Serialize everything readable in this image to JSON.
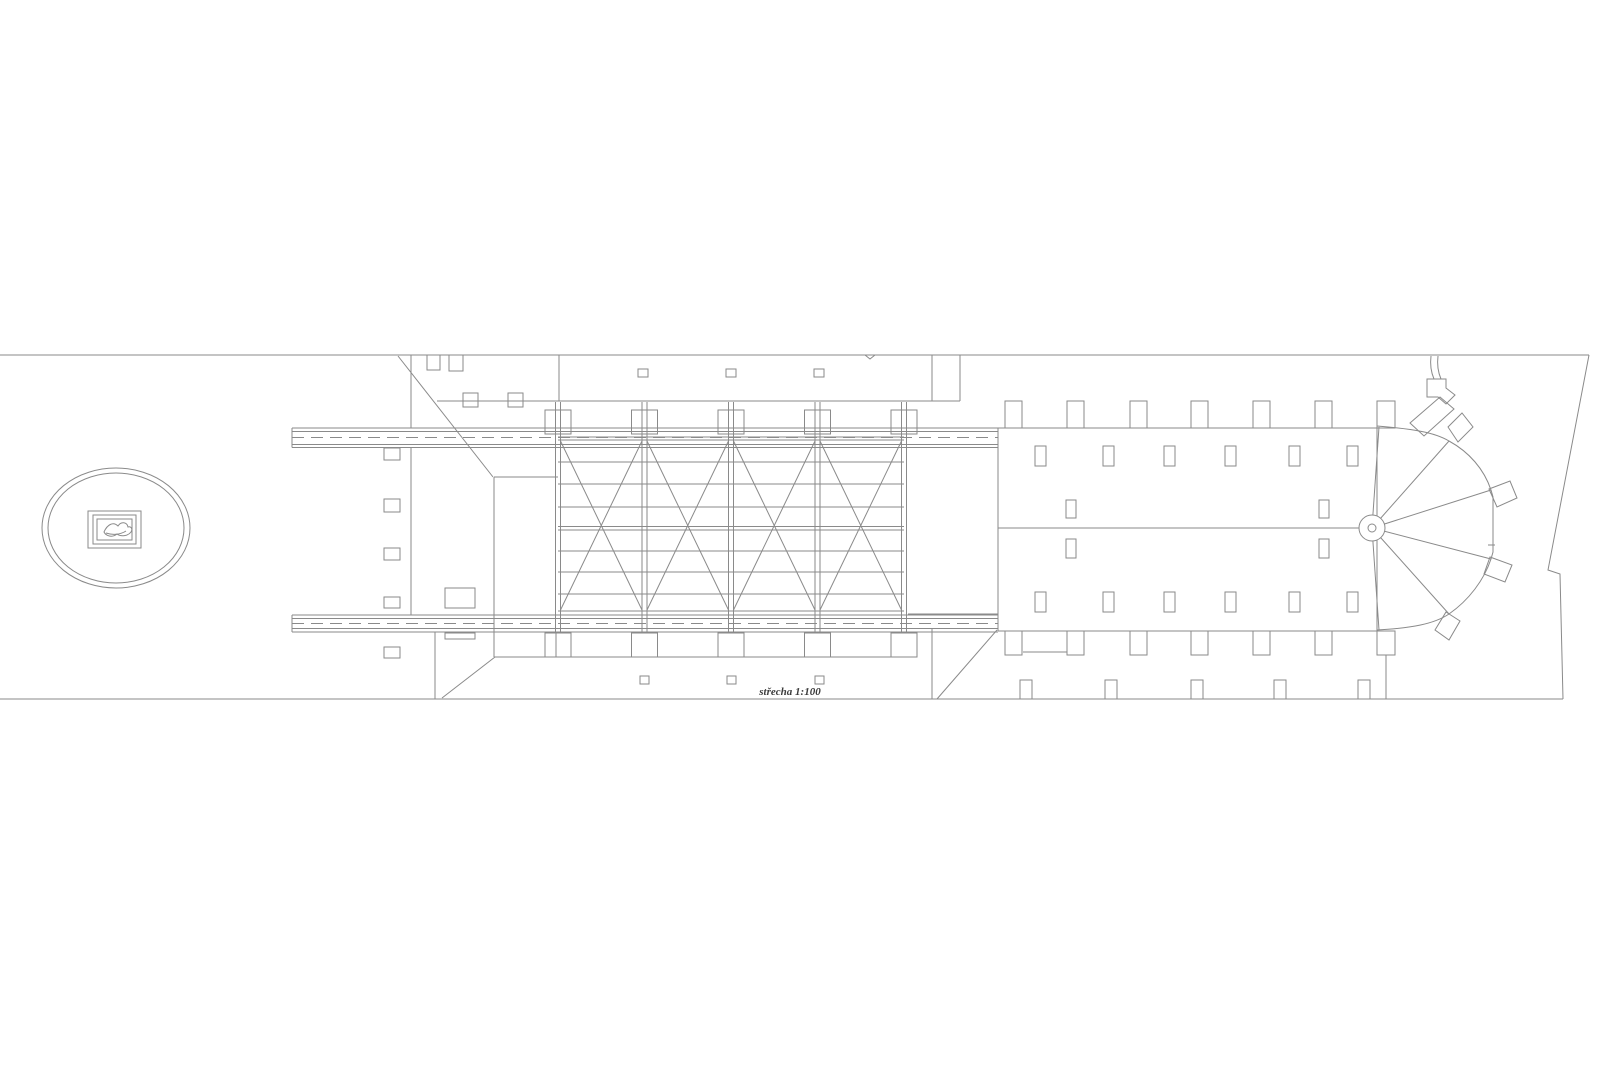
{
  "page": {
    "background": "#ffffff",
    "label": "střecha 1:100"
  },
  "drawing": {
    "stroke": "#8a8a8a",
    "stroke_width": 1,
    "dash": "12 7",
    "label_x": 790,
    "label_y": 695,
    "groups": [
      {
        "name": "site-boundary",
        "lines": [
          [
            0,
            355,
            1589,
            355
          ],
          [
            0,
            699,
            1563,
            699
          ]
        ],
        "polylines": [
          "1589,355 1548,570 1560,574 1563,699",
          "865,355 870,359 875,355"
        ]
      },
      {
        "name": "garden-ellipse-emblem",
        "ellipses": [
          [
            116,
            528,
            74,
            60
          ],
          [
            116,
            528,
            68,
            55
          ]
        ],
        "rects": [
          [
            88,
            511,
            53,
            37
          ],
          [
            93,
            515,
            43,
            29
          ],
          [
            97,
            519,
            35,
            21
          ]
        ],
        "paths": [
          "M104,532 C107,525 113,521 118,526 C121,521 127,522 128,527 C131,526 133,529 131,532 C128,536 121,537 117,534 C112,538 106,536 104,532 Z",
          "M106,533 C112,535 120,535 126,531"
        ]
      },
      {
        "name": "gallery-beams",
        "lines": [
          [
            292,
            428,
            1378,
            428
          ],
          [
            292,
            431.5,
            998,
            431.5
          ],
          [
            292,
            444.5,
            998,
            444.5
          ],
          [
            292,
            447.5,
            998,
            447.5
          ],
          [
            292,
            615,
            998,
            615
          ],
          [
            292,
            618.5,
            998,
            618.5
          ],
          [
            292,
            628.5,
            998,
            628.5
          ],
          [
            292,
            632,
            998,
            632
          ],
          [
            998,
            631,
            1378,
            631
          ],
          [
            292,
            428,
            292,
            447.5
          ],
          [
            292,
            615,
            292,
            632
          ]
        ],
        "dashed": [
          [
            292,
            437.5,
            998,
            437.5
          ],
          [
            292,
            623.5,
            998,
            623.5
          ]
        ]
      },
      {
        "name": "courtyard-walls",
        "lines": [
          [
            908,
            447.5,
            998,
            447.5
          ],
          [
            908,
            614,
            998,
            614
          ]
        ]
      },
      {
        "name": "north-wing",
        "lines": [
          [
            559,
            355,
            559,
            401
          ],
          [
            932,
            355,
            932,
            401
          ],
          [
            437,
            401,
            960,
            401
          ],
          [
            960,
            355,
            960,
            401
          ],
          [
            411,
            355,
            411,
            428
          ],
          [
            411,
            447,
            411,
            615
          ]
        ],
        "rects": [
          [
            638,
            369,
            10,
            8
          ],
          [
            726,
            369,
            10,
            8
          ],
          [
            814,
            369,
            10,
            8
          ],
          [
            427,
            355,
            13,
            15
          ],
          [
            449,
            355,
            14,
            16
          ],
          [
            463,
            393,
            15,
            14
          ],
          [
            508,
            393,
            15,
            14
          ]
        ]
      },
      {
        "name": "west-roof",
        "lines": [
          [
            398,
            356,
            493,
            477
          ],
          [
            494,
            477,
            558,
            477
          ],
          [
            494,
            477,
            494,
            657
          ],
          [
            435,
            632,
            435,
            699
          ],
          [
            556,
            633,
            556,
            657
          ],
          [
            494,
            657,
            908,
            657
          ],
          [
            495,
            657,
            442,
            698
          ]
        ],
        "rects": [
          [
            384,
            448,
            16,
            12
          ],
          [
            384,
            499,
            16,
            13
          ],
          [
            384,
            548,
            16,
            12
          ],
          [
            384,
            597,
            16,
            11
          ],
          [
            384,
            647,
            16,
            11
          ],
          [
            445,
            588,
            30,
            20
          ],
          [
            445,
            633,
            30,
            6
          ]
        ]
      },
      {
        "name": "south-wing",
        "lines": [
          [
            932,
            628,
            932,
            699
          ],
          [
            997,
            630,
            937,
            699
          ]
        ],
        "rects": [
          [
            640,
            676,
            9,
            8
          ],
          [
            727,
            676,
            9,
            8
          ],
          [
            815,
            676,
            9,
            8
          ]
        ]
      },
      {
        "name": "truss-verticals",
        "lines": [
          [
            555.5,
            402,
            555.5,
            633
          ],
          [
            560.5,
            402,
            560.5,
            633
          ],
          [
            642,
            402,
            642,
            633
          ],
          [
            647,
            402,
            647,
            633
          ],
          [
            728.5,
            402,
            728.5,
            633
          ],
          [
            733.5,
            402,
            733.5,
            633
          ],
          [
            815,
            402,
            815,
            633
          ],
          [
            820,
            402,
            820,
            633
          ],
          [
            901.5,
            402,
            901.5,
            633
          ],
          [
            906.5,
            402,
            906.5,
            633
          ]
        ],
        "rects": [
          [
            545,
            410,
            26,
            24
          ],
          [
            631.5,
            410,
            26,
            24
          ],
          [
            718,
            410,
            26,
            24
          ],
          [
            804.5,
            410,
            26,
            24
          ],
          [
            891,
            410,
            26,
            24
          ],
          [
            545,
            633,
            26,
            24
          ],
          [
            631.5,
            633,
            26,
            24
          ],
          [
            718,
            633,
            26,
            24
          ],
          [
            804.5,
            633,
            26,
            24
          ],
          [
            891,
            633,
            26,
            24
          ]
        ]
      },
      {
        "name": "truss-purlins",
        "lines": [
          [
            558,
            437,
            904,
            437
          ],
          [
            558,
            440,
            904,
            440
          ],
          [
            558,
            462,
            904,
            462
          ],
          [
            558,
            484,
            904,
            484
          ],
          [
            558,
            507,
            904,
            507
          ],
          [
            558,
            526.5,
            904,
            526.5
          ],
          [
            558,
            530,
            904,
            530
          ],
          [
            558,
            551,
            904,
            551
          ],
          [
            558,
            572,
            904,
            572
          ],
          [
            558,
            594,
            904,
            594
          ],
          [
            558,
            611,
            904,
            611
          ]
        ]
      },
      {
        "name": "truss-bracing",
        "lines": [
          [
            560.5,
            441,
            642,
            610
          ],
          [
            560.5,
            610,
            642,
            441
          ],
          [
            647,
            441,
            728.5,
            610
          ],
          [
            647,
            610,
            728.5,
            441
          ],
          [
            733.5,
            441,
            815,
            610
          ],
          [
            733.5,
            610,
            815,
            441
          ],
          [
            820,
            441,
            901.5,
            610
          ],
          [
            820,
            610,
            901.5,
            441
          ]
        ]
      },
      {
        "name": "nave-roof",
        "lines": [
          [
            998,
            428,
            998,
            631
          ],
          [
            1377,
            428,
            1377,
            631
          ],
          [
            998,
            528,
            1359,
            528
          ],
          [
            1023,
            652,
            1067,
            652
          ],
          [
            1386,
            655,
            1386,
            699
          ]
        ],
        "rects": [
          [
            1005,
            401,
            17,
            27
          ],
          [
            1067,
            401,
            17,
            27
          ],
          [
            1130,
            401,
            17,
            27
          ],
          [
            1191,
            401,
            17,
            27
          ],
          [
            1253,
            401,
            17,
            27
          ],
          [
            1315,
            401,
            17,
            27
          ],
          [
            1377,
            401,
            18,
            27
          ],
          [
            1005,
            631,
            17,
            24
          ],
          [
            1067,
            631,
            17,
            24
          ],
          [
            1130,
            631,
            17,
            24
          ],
          [
            1191,
            631,
            17,
            24
          ],
          [
            1253,
            631,
            17,
            24
          ],
          [
            1315,
            631,
            17,
            24
          ],
          [
            1377,
            631,
            18,
            24
          ],
          [
            1035,
            446,
            11,
            20
          ],
          [
            1103,
            446,
            11,
            20
          ],
          [
            1164,
            446,
            11,
            20
          ],
          [
            1225,
            446,
            11,
            20
          ],
          [
            1289,
            446,
            11,
            20
          ],
          [
            1347,
            446,
            11,
            20
          ],
          [
            1035,
            592,
            11,
            20
          ],
          [
            1103,
            592,
            11,
            20
          ],
          [
            1164,
            592,
            11,
            20
          ],
          [
            1225,
            592,
            11,
            20
          ],
          [
            1289,
            592,
            11,
            20
          ],
          [
            1347,
            592,
            11,
            20
          ],
          [
            1066,
            500,
            10,
            18
          ],
          [
            1066,
            539,
            10,
            19
          ],
          [
            1319,
            500,
            10,
            18
          ],
          [
            1319,
            539,
            10,
            19
          ],
          [
            1020,
            680,
            12,
            19
          ],
          [
            1105,
            680,
            12,
            19
          ],
          [
            1191,
            680,
            12,
            19
          ],
          [
            1274,
            680,
            12,
            19
          ],
          [
            1358,
            680,
            12,
            19
          ]
        ]
      },
      {
        "name": "apse-roof",
        "paths": [
          "M1377,426 C1412,429 1434,432 1449,441 C1469,452 1484,469 1491,490 L1493,497 L1493,552 L1491,559 C1484,580 1469,600 1449,614 C1434,624 1412,628 1377,630"
        ],
        "lines": [
          [
            1372,
            528,
            1379,
            427
          ],
          [
            1372,
            528,
            1449,
            441
          ],
          [
            1372,
            528,
            1491,
            490
          ],
          [
            1372,
            528,
            1491,
            559
          ],
          [
            1372,
            528,
            1449,
            614
          ],
          [
            1372,
            528,
            1379,
            630
          ],
          [
            1488,
            545,
            1495,
            545
          ]
        ]
      },
      {
        "name": "apse-hub",
        "fill": "#ffffff",
        "circles": [
          [
            1372,
            528,
            13
          ],
          [
            1372,
            528,
            4
          ]
        ]
      },
      {
        "name": "apse-buttresses",
        "polygons": [
          "1410,423 1440,397 1454,409 1424,436",
          "1448,427 1462,413 1473,427 1458,442",
          "1489,489 1510,481 1517,498 1497,507",
          "1490,557 1512,565 1505,582 1484,574",
          "1446,612 1460,621 1449,640 1435,630"
        ]
      },
      {
        "name": "apse-stack",
        "paths": [
          "M1431,356 C1430,364 1431,372 1434,379",
          "M1438,356 C1437,364 1438,372 1441,379"
        ],
        "polygons": [
          "1427,379 1446,379 1446,388 1455,395 1446,404 1438,397 1427,397"
        ]
      }
    ]
  }
}
